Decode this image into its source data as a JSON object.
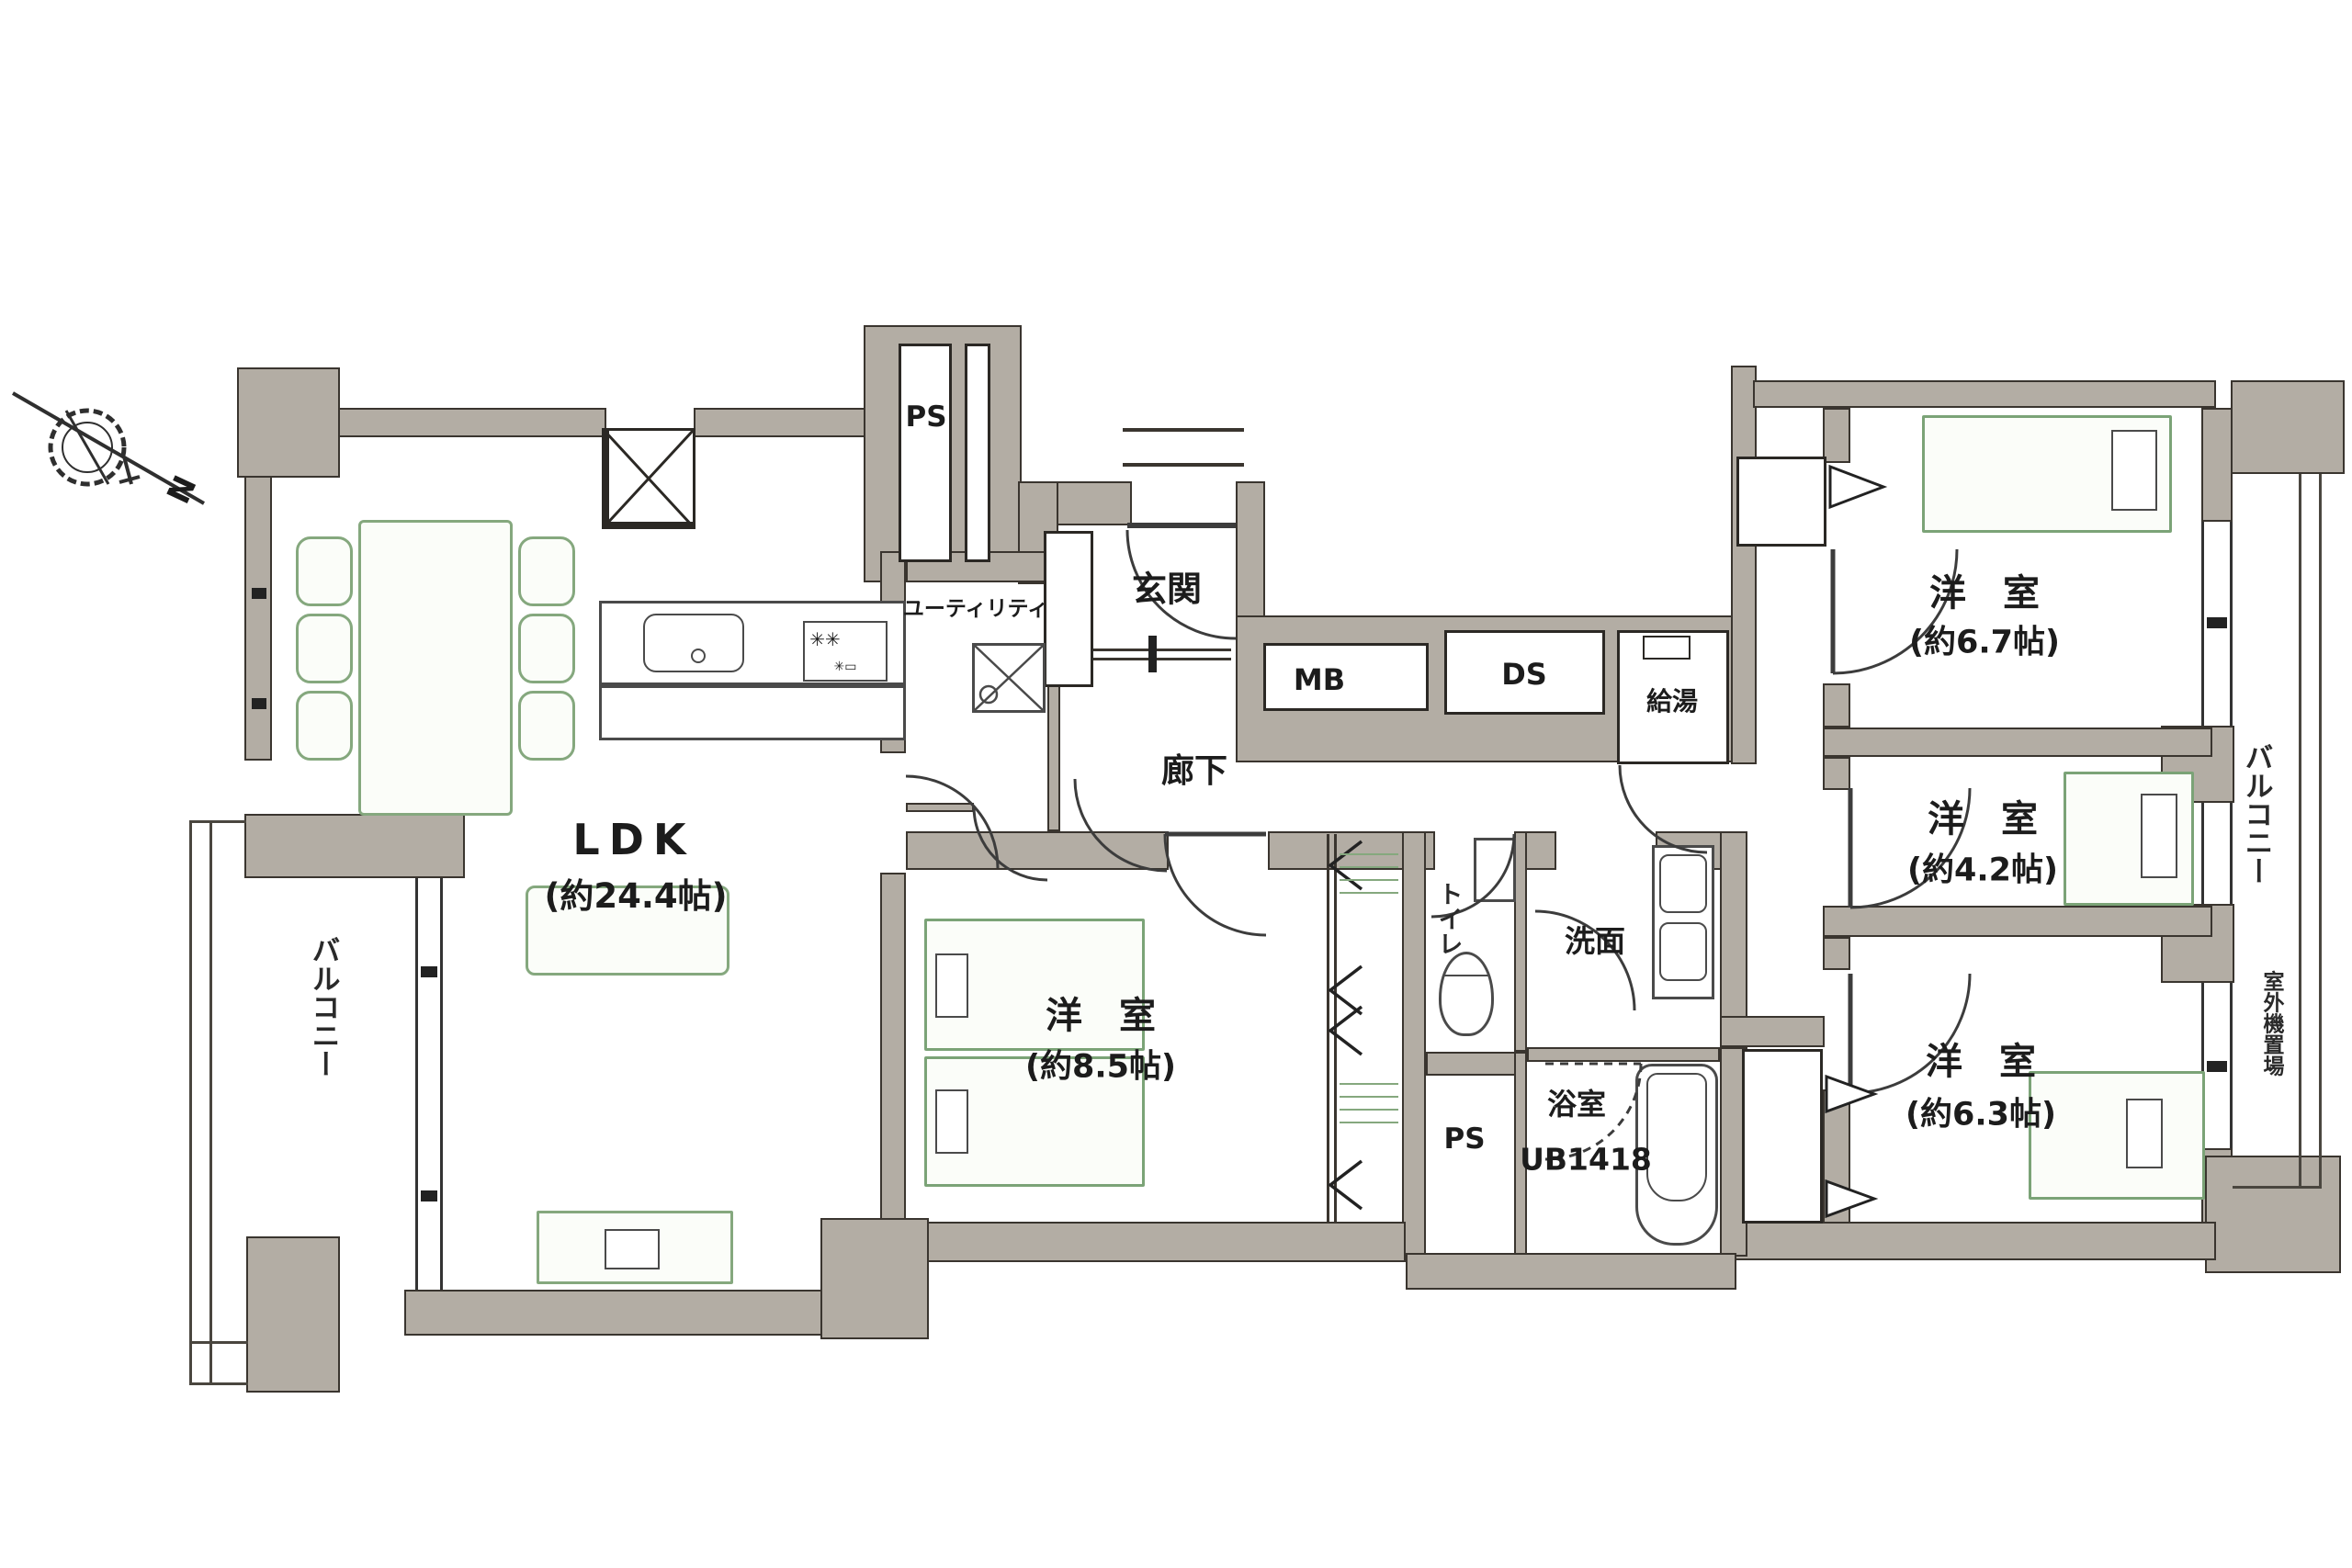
{
  "plan": {
    "rooms": {
      "ldk": {
        "name": "LDK",
        "size": "(約24.4帖)"
      },
      "bedroom85": {
        "name": "洋　室",
        "size": "(約8.5帖)"
      },
      "bedroom67": {
        "name": "洋　室",
        "size": "(約6.7帖)"
      },
      "bedroom42": {
        "name": "洋　室",
        "size": "(約4.2帖)"
      },
      "bedroom63": {
        "name": "洋　室",
        "size": "(約6.3帖)"
      },
      "entrance": {
        "name": "玄関"
      },
      "hallway": {
        "name": "廊下"
      },
      "utility": {
        "name": "ユーティリティ"
      },
      "washroom": {
        "name": "洗面"
      },
      "toilet": {
        "name": "トイレ"
      },
      "bathroom": {
        "name": "浴室",
        "size": "UB1418"
      },
      "balcony_left": {
        "name": "バルコニー"
      },
      "balcony_right": {
        "name": "バルコニー"
      },
      "outdoor_unit": {
        "name": "室外機置場"
      },
      "ps_top": {
        "name": "PS"
      },
      "ps_bottom": {
        "name": "PS"
      },
      "mb": {
        "name": "MB"
      },
      "ds": {
        "name": "DS"
      },
      "water_heater": {
        "name": "給湯"
      }
    },
    "compass": {
      "label": "N"
    },
    "colors": {
      "wall": "#b3ada4",
      "outline": "#3a352f",
      "furniture": "#85a87e",
      "text": "#1c1c1c"
    }
  }
}
